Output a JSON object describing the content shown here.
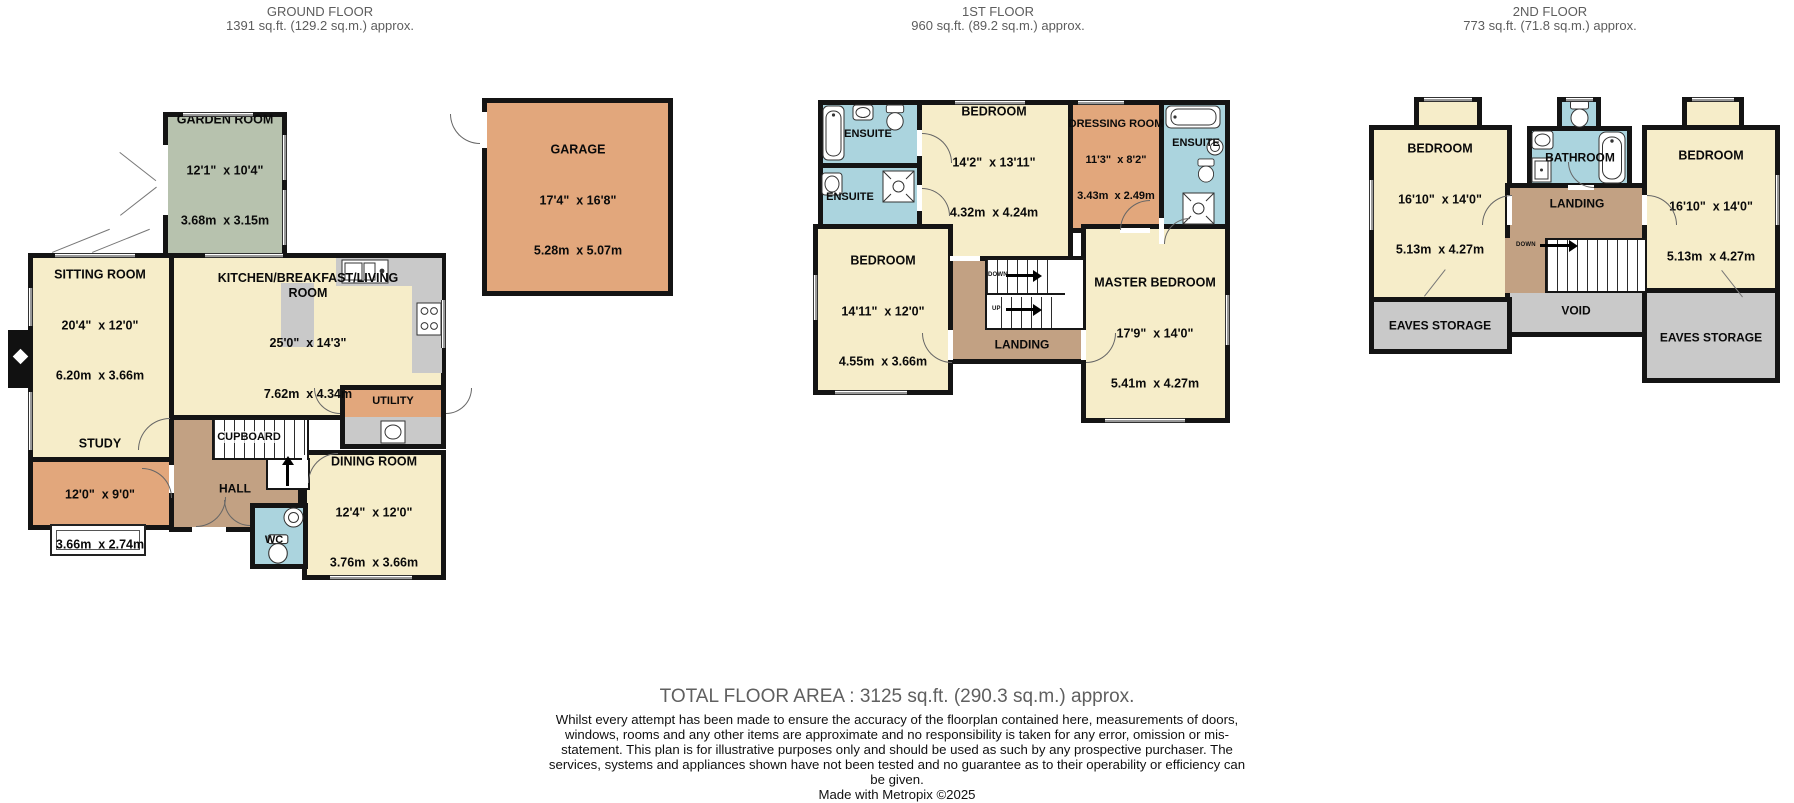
{
  "colors": {
    "cream": "#f6edc9",
    "green": "#b7c2ae",
    "orange": "#e2a77c",
    "tan": "#c2a183",
    "blue": "#abd4de",
    "gray": "#c9c9c9",
    "wall": "#141414"
  },
  "labels": {
    "up": "UP",
    "down": "DOWN"
  },
  "icons": {
    "toilet": "toilet-icon",
    "bathtub": "bathtub-icon",
    "sink": "sink-icon",
    "shower": "shower-icon",
    "stove": "stove-icon",
    "kitchen_sink": "kitchen-sink-icon",
    "cabinet": "cabinet-icon"
  },
  "floors": [
    {
      "name": "GROUND FLOOR",
      "area": "1391 sq.ft. (129.2 sq.m.) approx.",
      "rooms": {
        "garden": {
          "name": "GARDEN ROOM",
          "ft": "12'1\"  x 10'4\"",
          "m": "3.68m  x 3.15m"
        },
        "sitting": {
          "name": "SITTING ROOM",
          "ft": "20'4\"  x 12'0\"",
          "m": "6.20m  x 3.66m"
        },
        "kitchen": {
          "name": "KITCHEN/BREAKFAST/LIVING ROOM",
          "ft": "25'0\"  x 14'3\"",
          "m": "7.62m  x 4.34m"
        },
        "study": {
          "name": "STUDY",
          "ft": "12'0\"  x 9'0\"",
          "m": "3.66m  x 2.74m"
        },
        "dining": {
          "name": "DINING ROOM",
          "ft": "12'4\"  x 12'0\"",
          "m": "3.76m  x 3.66m"
        },
        "garage": {
          "name": "GARAGE",
          "ft": "17'4\"  x 16'8\"",
          "m": "5.28m  x 5.07m"
        },
        "hall": {
          "name": "HALL"
        },
        "cupboard": {
          "name": "CUPBOARD"
        },
        "wc": {
          "name": "WC"
        },
        "utility": {
          "name": "UTILITY"
        }
      }
    },
    {
      "name": "1ST FLOOR",
      "area": "960 sq.ft. (89.2 sq.m.) approx.",
      "rooms": {
        "bedroom1": {
          "name": "BEDROOM",
          "ft": "14'2\"  x 13'11\"",
          "m": "4.32m  x 4.24m"
        },
        "dressing": {
          "name": "DRESSING ROOM",
          "ft": "11'3\"  x 8'2\"",
          "m": "3.43m  x 2.49m"
        },
        "bedroom2": {
          "name": "BEDROOM",
          "ft": "14'11\"  x 12'0\"",
          "m": "4.55m  x 3.66m"
        },
        "master": {
          "name": "MASTER BEDROOM",
          "ft": "17'9\"  x 14'0\"",
          "m": "5.41m  x 4.27m"
        },
        "ensuite1": {
          "name": "ENSUITE"
        },
        "ensuite2": {
          "name": "ENSUITE"
        },
        "ensuite3": {
          "name": "ENSUITE"
        },
        "landing": {
          "name": "LANDING"
        }
      }
    },
    {
      "name": "2ND FLOOR",
      "area": "773 sq.ft. (71.8 sq.m.) approx.",
      "rooms": {
        "bedroom_left": {
          "name": "BEDROOM",
          "ft": "16'10\"  x 14'0\"",
          "m": "5.13m  x 4.27m"
        },
        "bedroom_right": {
          "name": "BEDROOM",
          "ft": "16'10\"  x 14'0\"",
          "m": "5.13m  x 4.27m"
        },
        "bathroom": {
          "name": "BATHROOM"
        },
        "landing": {
          "name": "LANDING"
        },
        "void": {
          "name": "VOID"
        },
        "eaves_left": {
          "name": "EAVES STORAGE"
        },
        "eaves_right": {
          "name": "EAVES STORAGE"
        }
      }
    }
  ],
  "footer": {
    "total": "TOTAL FLOOR AREA : 3125 sq.ft. (290.3 sq.m.) approx.",
    "disclaimer": "Whilst every attempt has been made to ensure the accuracy of the floorplan contained here, measurements of doors, windows, rooms and any other items are approximate and no responsibility is taken for any error, omission or mis-statement. This plan is for illustrative purposes only and should be used as such by any prospective purchaser. The services, systems and appliances shown have not been tested and no guarantee as to their operability or efficiency can be given.",
    "credit": "Made with Metropix ©2025"
  }
}
